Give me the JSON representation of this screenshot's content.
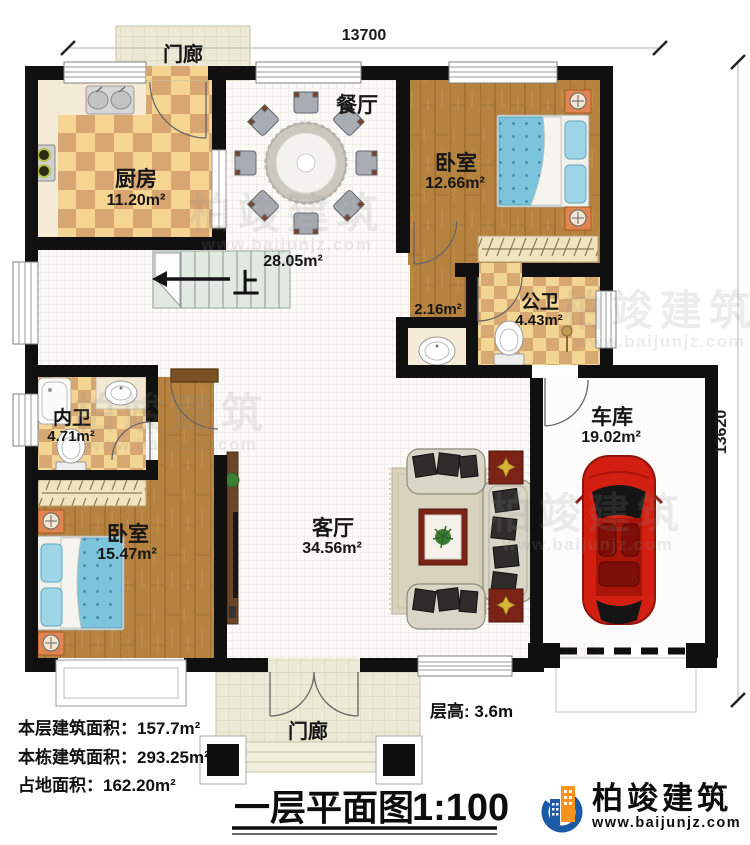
{
  "dimensions": {
    "top": "13700",
    "right": "13620"
  },
  "rooms": {
    "porch_top": {
      "name": "门廊"
    },
    "kitchen": {
      "name": "厨房",
      "area": "11.20m²"
    },
    "dining": {
      "name": "餐厅",
      "area": "28.05m²"
    },
    "bedroom_top": {
      "name": "卧室",
      "area": "12.66m²"
    },
    "public_bath": {
      "name": "公卫",
      "area": "4.43m²"
    },
    "wash_closet": {
      "area": "2.16m²"
    },
    "inner_bath": {
      "name": "内卫",
      "area": "4.71m²"
    },
    "bedroom_left": {
      "name": "卧室",
      "area": "15.47m²"
    },
    "living": {
      "name": "客厅",
      "area": "34.56m²"
    },
    "garage": {
      "name": "车库",
      "area": "19.02m²"
    },
    "porch_bottom": {
      "name": "门廊"
    },
    "stairs": {
      "direction_label": "上"
    }
  },
  "annotations": {
    "floor_height": "层高: 3.6m"
  },
  "stats": {
    "floor_area": "本层建筑面积：157.7m²",
    "building_total_area": "本栋建筑面积：293.25m²",
    "land_area": "占地面积：162.20m²"
  },
  "title": {
    "name": "一层平面图",
    "scale": "1:100"
  },
  "brand": {
    "name": "柏竣建筑",
    "url": "www.baijunjz.com"
  },
  "watermark": {
    "name": "柏竣建筑",
    "url": "www.baijunjz.com"
  },
  "colors": {
    "wall": "#101010",
    "wood": "#b5823f",
    "tile_light": "#f6d492",
    "tile_dark": "#d9a570",
    "accent_blue": "#1a5aa6",
    "accent_orange": "#f7941d",
    "bed": "#7cc4dc",
    "car": "#d21f12"
  }
}
